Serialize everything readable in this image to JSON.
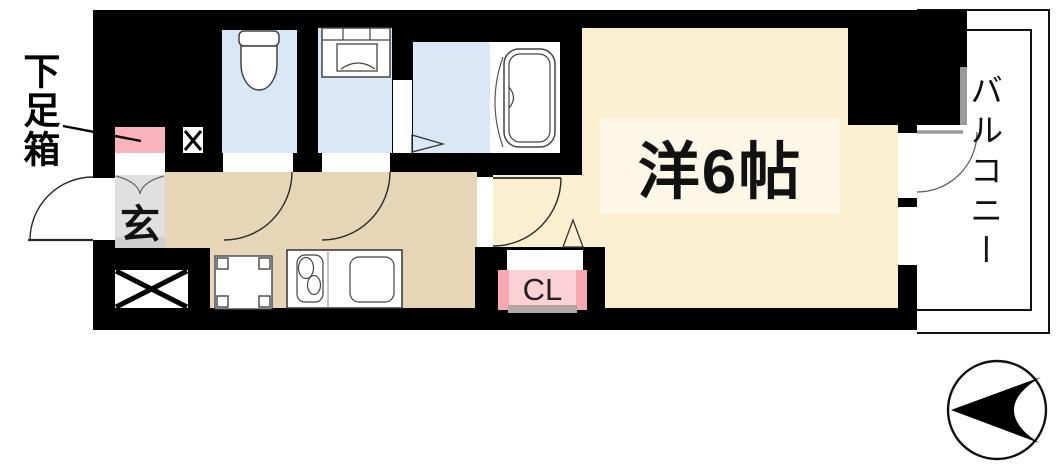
{
  "floor_plan": {
    "labels": {
      "shoe_box": "下足箱",
      "entrance": "玄",
      "closet": "CL",
      "main_room": "洋6帖",
      "balcony": "バルコニー"
    },
    "colors": {
      "wall": "#000000",
      "hallway_floor": "#e6d5b7",
      "main_room_floor": "#fbefd1",
      "main_room_label_bg": "#fdf7e8",
      "wet_area_floor": "#d9e7f6",
      "entrance_floor": "#e0e0e0",
      "shoe_box_fill": "#f8b4ba",
      "closet_fill": "#fbd1d5",
      "closet_edge_fill": "#f6a9b2",
      "balcony_fill": "#ffffff",
      "door_leaf_gray": "#9a9a9a"
    },
    "fixtures": [
      "toilet",
      "washing-machine",
      "bathtub",
      "kitchen-counter",
      "stove",
      "sink",
      "refrigerator-space",
      "pipe-space",
      "meter-box",
      "north-compass"
    ]
  }
}
